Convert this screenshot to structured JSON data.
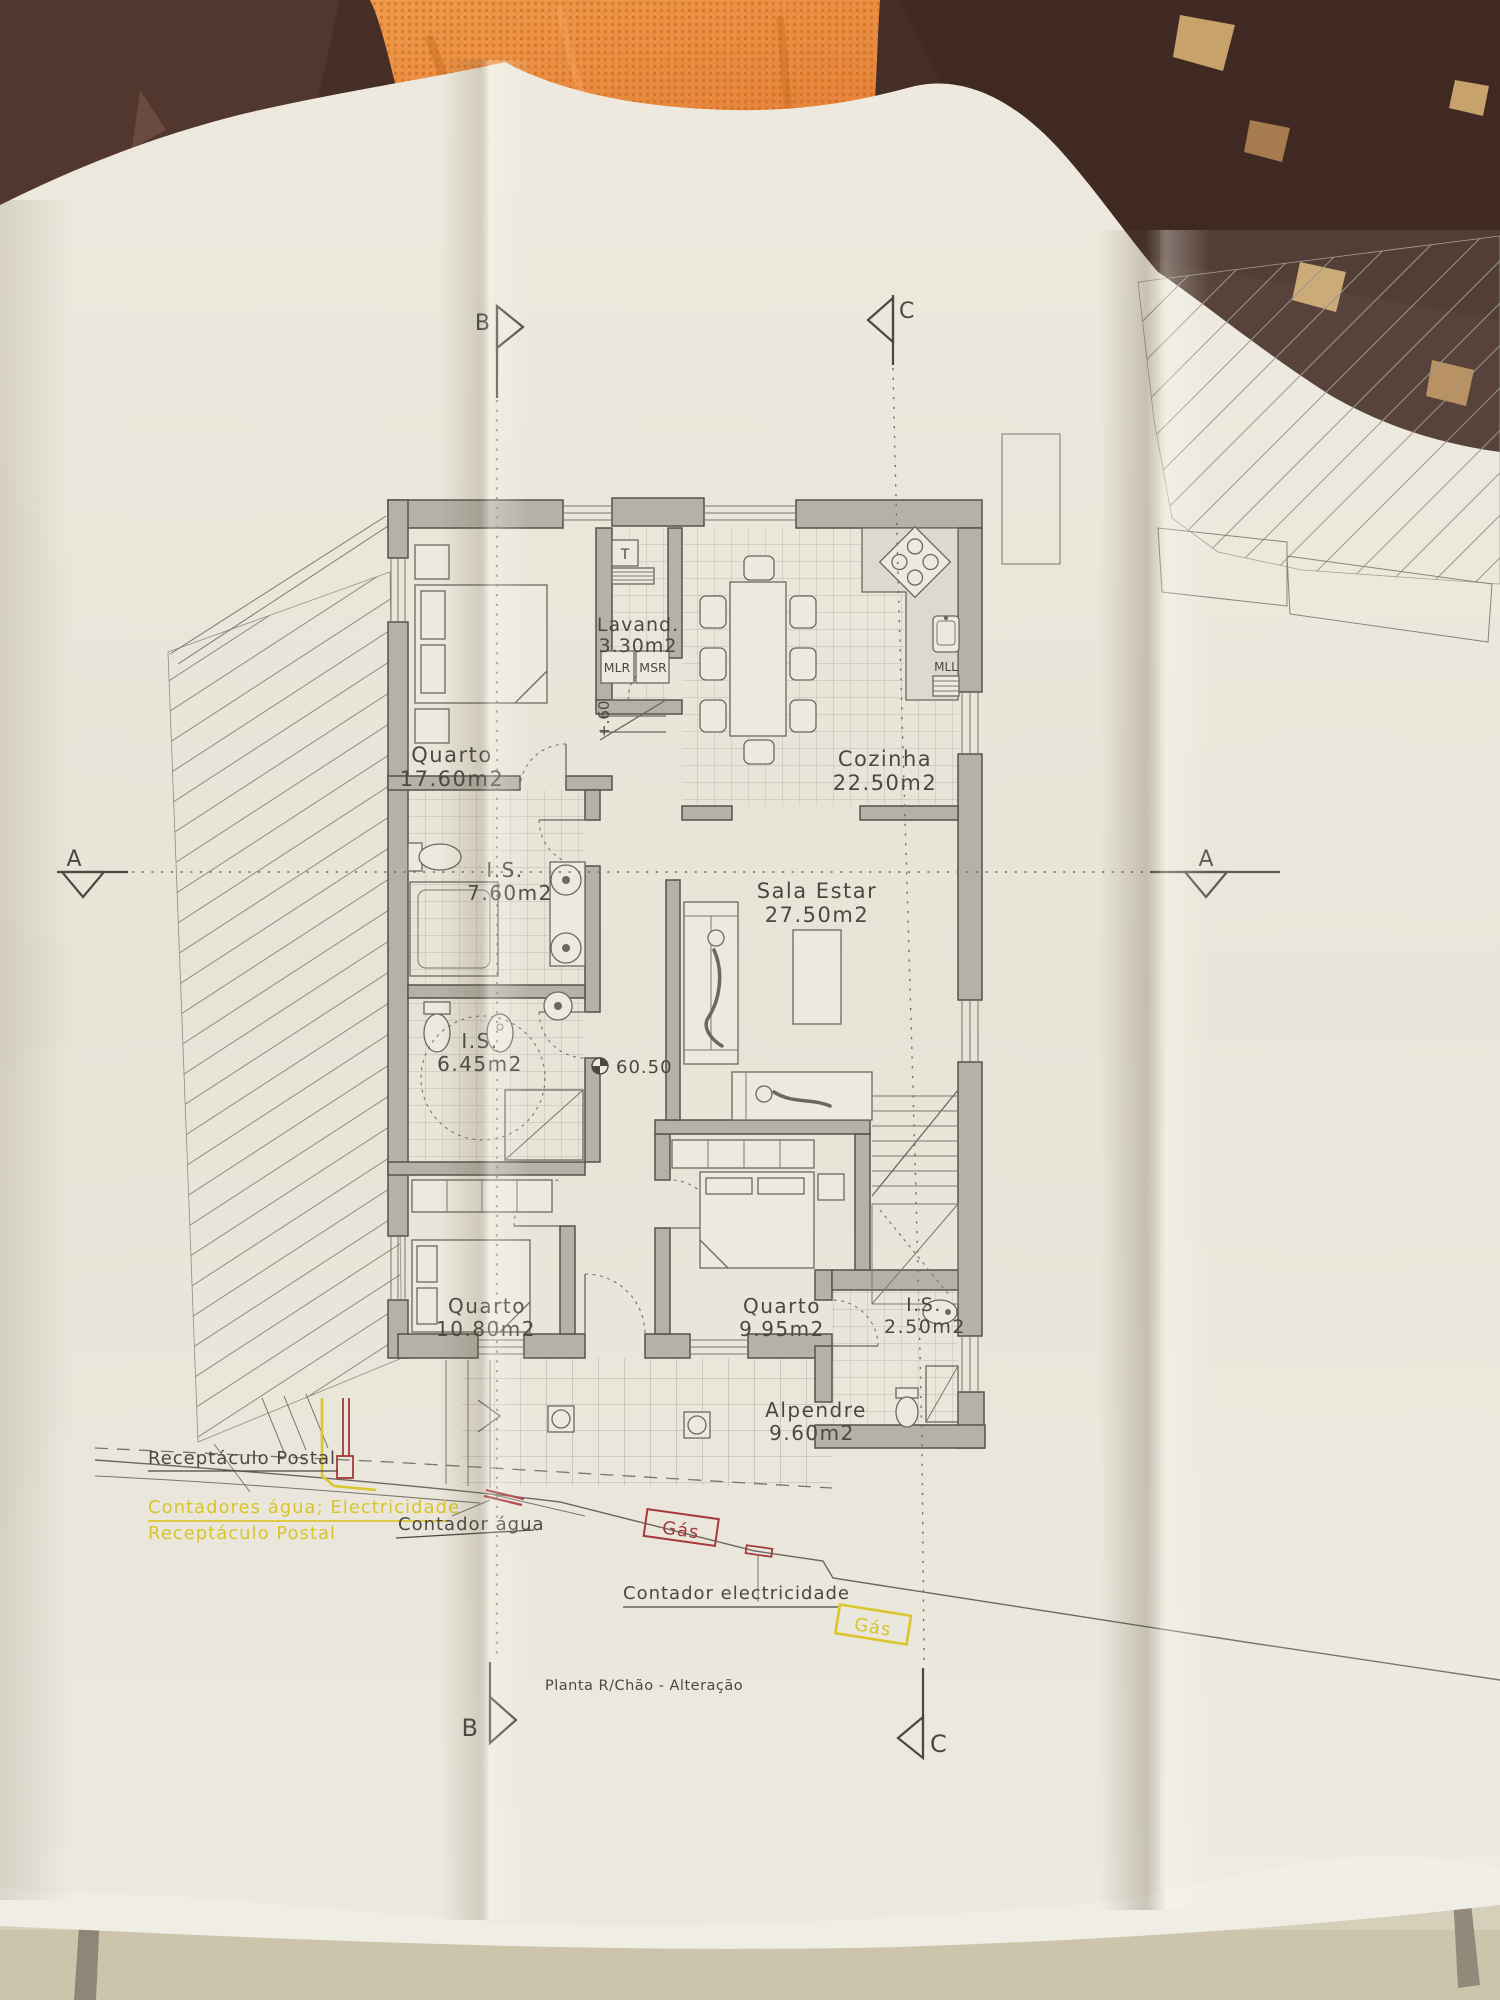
{
  "photo": {
    "background_colors": {
      "table_brown": "#462e27",
      "cloth_orange": "#e5883c",
      "paper": "#eae6db",
      "surface_beige": "#d6d0ba"
    }
  },
  "plan": {
    "title": "Planta R/Chão - Alteração",
    "rooms": [
      {
        "name": "Quarto",
        "area": "17.60m2"
      },
      {
        "name": "Lavand.",
        "area": "3.30m2"
      },
      {
        "name": "Cozinha",
        "area": "22.50m2"
      },
      {
        "name": "I.S.",
        "area": "7.60m2"
      },
      {
        "name": "Sala Estar",
        "area": "27.50m2"
      },
      {
        "name": "I.S.",
        "area": "6.45m2"
      },
      {
        "name": "Quarto",
        "area": "10.80m2"
      },
      {
        "name": "Quarto",
        "area": "9.95m2"
      },
      {
        "name": "I.S.",
        "area": "2.50m2"
      },
      {
        "name": "Alpendre",
        "area": "9.60m2"
      }
    ],
    "appliances": {
      "water_heater": "T",
      "washer": "MLR",
      "dryer": "MSR",
      "dishwasher": "MLL"
    },
    "levels": {
      "step": "+.60",
      "floor": "60.50"
    },
    "sections": {
      "a": "A",
      "b": "B",
      "c": "C"
    },
    "annotations": {
      "postal_existing": "Receptáculo Postal",
      "meters_new": "Contadores água; Electricidade",
      "postal_new": "Receptáculo Postal",
      "water_meter": "Contador água",
      "gas_1": "Gás",
      "electric_meter": "Contador electricidade",
      "gas_2": "Gás"
    },
    "annotation_colors": {
      "yellow": "#ddc52e",
      "red": "#a6393a",
      "ink": "#4b4842"
    }
  }
}
